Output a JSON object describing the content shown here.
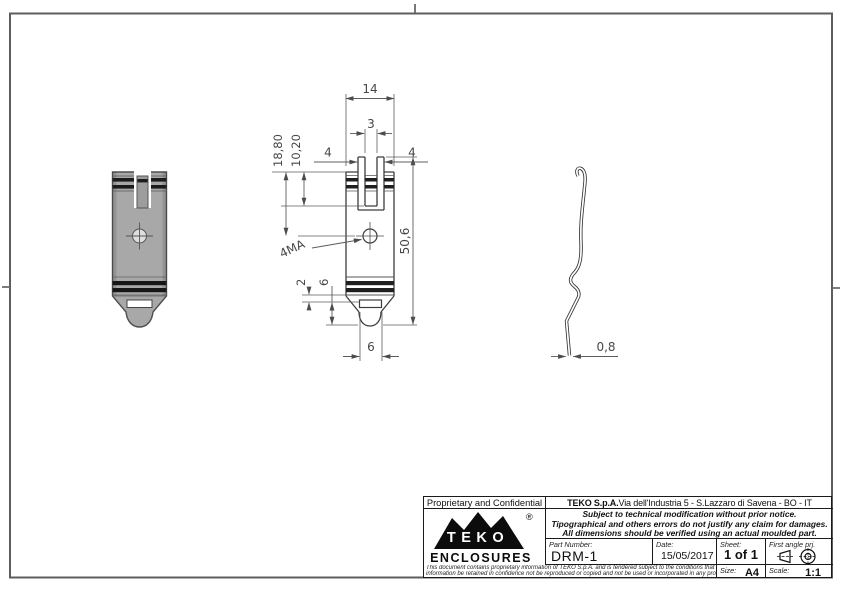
{
  "drawing": {
    "dims": {
      "top_width": "14",
      "slot_width": "3",
      "left_offset": "4",
      "right_offset": "4",
      "depth_hole": "18,80",
      "depth_slot": "10,20",
      "total_height": "50,6",
      "thread": "4MA",
      "rib_height": "2",
      "slot_height": "6",
      "bottom_width": "6",
      "thickness": "0,8"
    }
  },
  "title_block": {
    "proprietary": "Proprietary and Confidential",
    "company_bold": "TEKO S.p.A.",
    "company_address": " Via dell'Industria 5 - S.Lazzaro di Savena - BO - IT",
    "notice_line1": "Subject to technical modification without prior notice.",
    "notice_line2": "Tipographical and others errors do not justify any claim for damages.",
    "notice_line3": "All dimensions should be verified using an actual moulded part.",
    "part_number_label": "Part Number:",
    "part_number": "DRM-1",
    "date_label": "Date:",
    "date": "15/05/2017",
    "sheet_label": "Sheet:",
    "sheet": "1 of 1",
    "projection_label": "First angle prj.",
    "size_label": "Size:",
    "size": "A4",
    "scale_label": "Scale:",
    "scale": "1:1",
    "fine_print_line1": "This document contains proprietary information of TEKO S.p.A. and is tendered subject to the conditions that the",
    "fine_print_line2": "information be retained in confidence not be reproduced or copied and not be used or incorporated in any product",
    "logo": {
      "brand": "TEKO",
      "sub": "ENCLOSURES",
      "reg": "®"
    }
  }
}
